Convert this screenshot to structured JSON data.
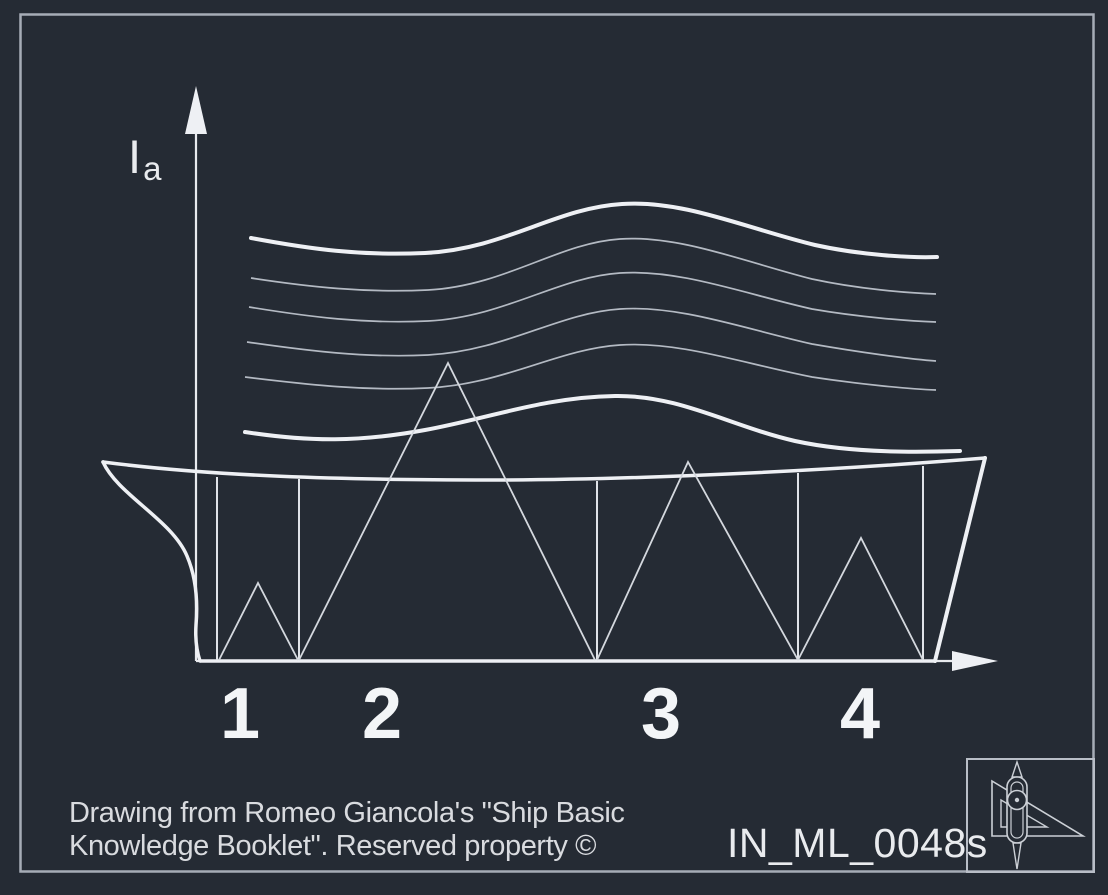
{
  "colors": {
    "background": "#252b34",
    "frame_border": "#a6acb6",
    "bright_line": "#eef0f4",
    "thin_curve": "#b4bac3",
    "station_line": "#e0e3e8",
    "zigzag_line": "#d4d8de",
    "text_bright": "#f3f5f7",
    "text_caption": "#d9dbdf"
  },
  "diagram": {
    "y_axis_label": {
      "main": "I",
      "sub": "a"
    },
    "stations": [
      {
        "label": "1"
      },
      {
        "label": "2"
      },
      {
        "label": "3"
      },
      {
        "label": "4"
      }
    ]
  },
  "footer": {
    "credit_line1": "Drawing from Romeo Giancola's \"Ship Basic",
    "credit_line2": "Knowledge Booklet\". Reserved property ©",
    "code": "IN_ML_0048s"
  },
  "icons": {
    "logo": "drafting-compass-and-set-square"
  }
}
